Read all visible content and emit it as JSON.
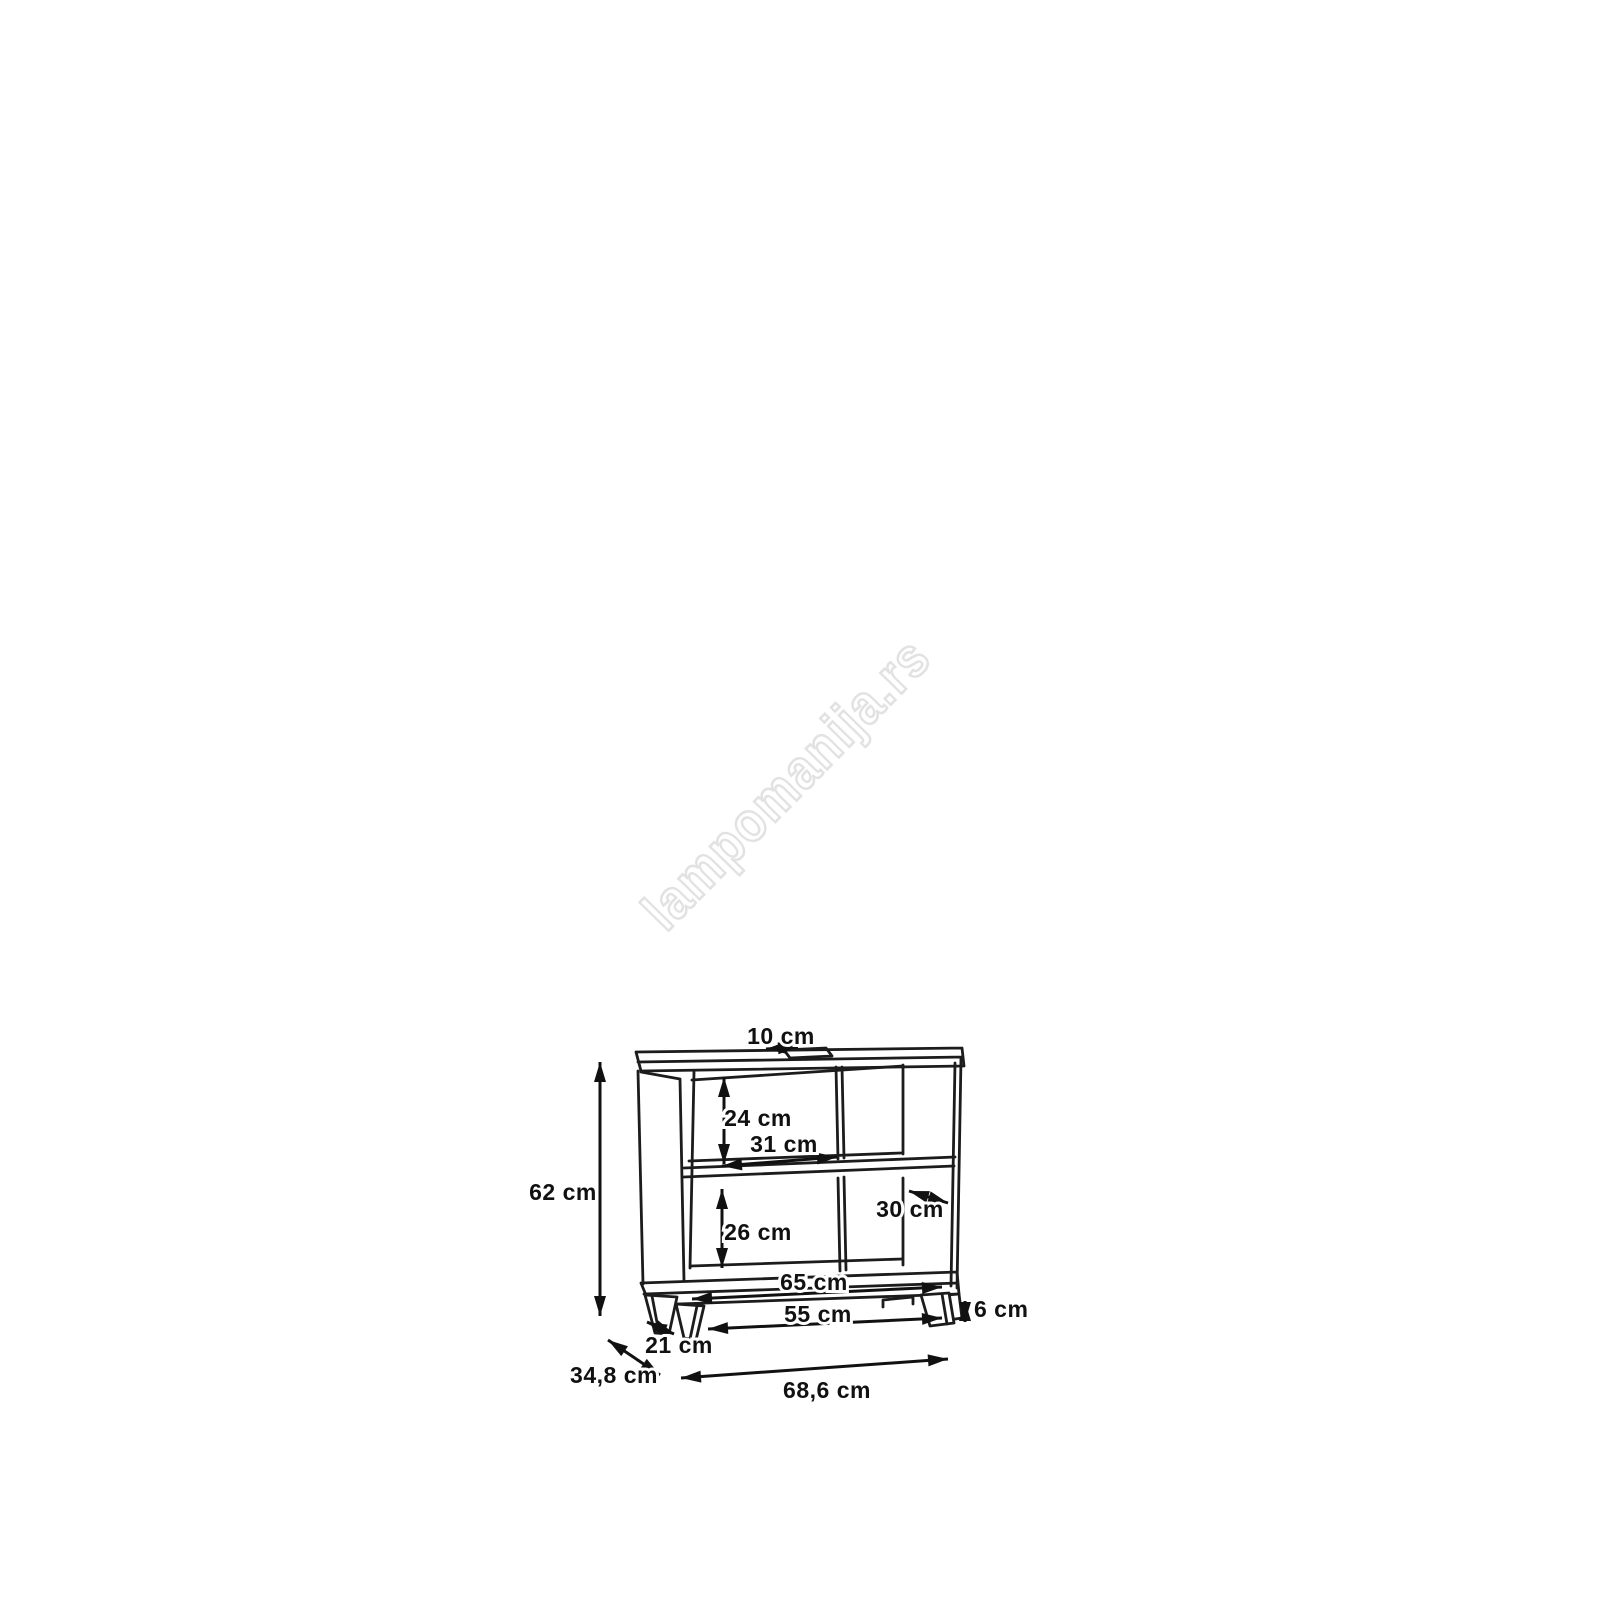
{
  "diagram": {
    "title": "cabinet-dimension-drawing",
    "watermark": "lampomanija.rs",
    "colors": {
      "background": "#ffffff",
      "line": "#1c1c1c",
      "label_text": "#111111",
      "watermark": "#e2e2e2"
    },
    "dimensions": {
      "top_cutout_width": "10 cm",
      "overall_height": "62 cm",
      "upper_compartment_height": "24 cm",
      "upper_compartment_width": "31 cm",
      "lower_compartment_height": "26 cm",
      "compartment_depth": "30 cm",
      "inner_bottom_width": "65 cm",
      "base_width": "55 cm",
      "base_height": "6 cm",
      "foot_depth": "21 cm",
      "overall_depth": "34,8 cm",
      "overall_width": "68,6 cm"
    }
  }
}
